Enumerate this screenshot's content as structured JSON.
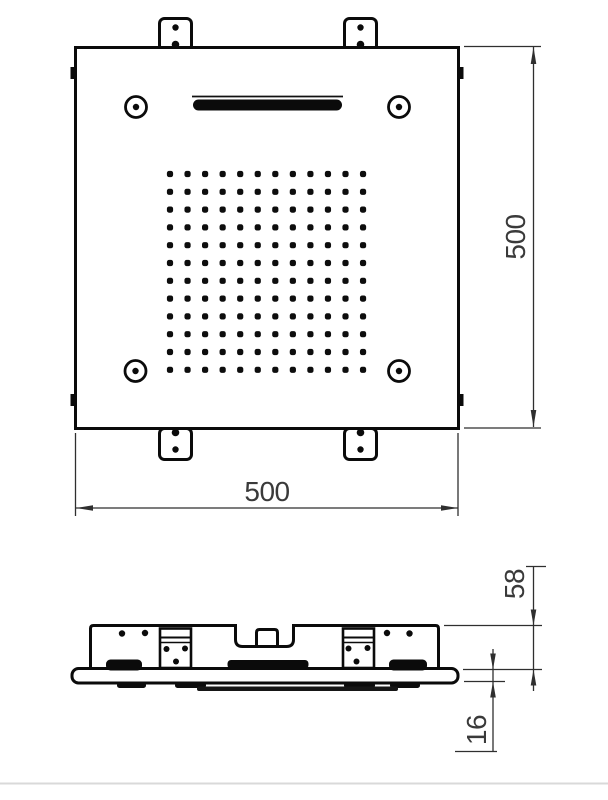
{
  "page": {
    "background_color": "#ffffff",
    "footer_rule_color": "#d9d9d9"
  },
  "drawing": {
    "type": "technical-drawing",
    "subject": "square ceiling shower head, plan view and side section view",
    "line_color": "#0b0b0b",
    "dim_line_color": "#2f2f2f",
    "dim_text_color": "#3a3a3a"
  },
  "top_view": {
    "width_dimension": {
      "label": "500"
    },
    "height_dimension": {
      "label": "500"
    },
    "nozzle_grid": {
      "rows": 12,
      "cols": 12
    },
    "features": {
      "corner_screws": 4,
      "mounting_brackets": 4,
      "waterfall_slot": 1
    }
  },
  "side_view": {
    "height_dimension": {
      "label": "58"
    },
    "plate_thickness_dimension": {
      "label": "16"
    }
  }
}
